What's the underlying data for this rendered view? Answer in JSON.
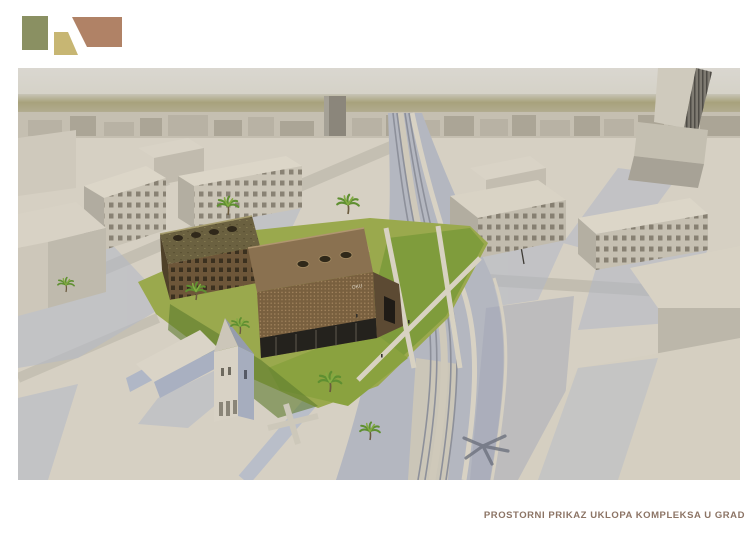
{
  "logo": {
    "shapes": [
      {
        "name": "green-square",
        "color": "#8a9062"
      },
      {
        "name": "khaki-trapezoid",
        "color": "#c7b673"
      },
      {
        "name": "brown-trapezoid",
        "color": "#b08266"
      }
    ]
  },
  "render": {
    "facade_sign": "OKU",
    "palette": {
      "sky": "#d8d5cd",
      "horizon_band": "#a8a27c",
      "city_model": "#d6d0c3",
      "shadow_blue": "#b2b8c7",
      "road": "#b4b7c0",
      "lawn_light": "#9aa94d",
      "lawn_dark": "#7f9c3c",
      "building_facade": "#79603f",
      "building_roof": "#8a7150",
      "palm_green": "#5f8f31"
    }
  },
  "caption": {
    "text": "PROSTORNI PRIKAZ UKLOPA KOMPLEKSA U GRAD",
    "color": "#8c7465"
  }
}
